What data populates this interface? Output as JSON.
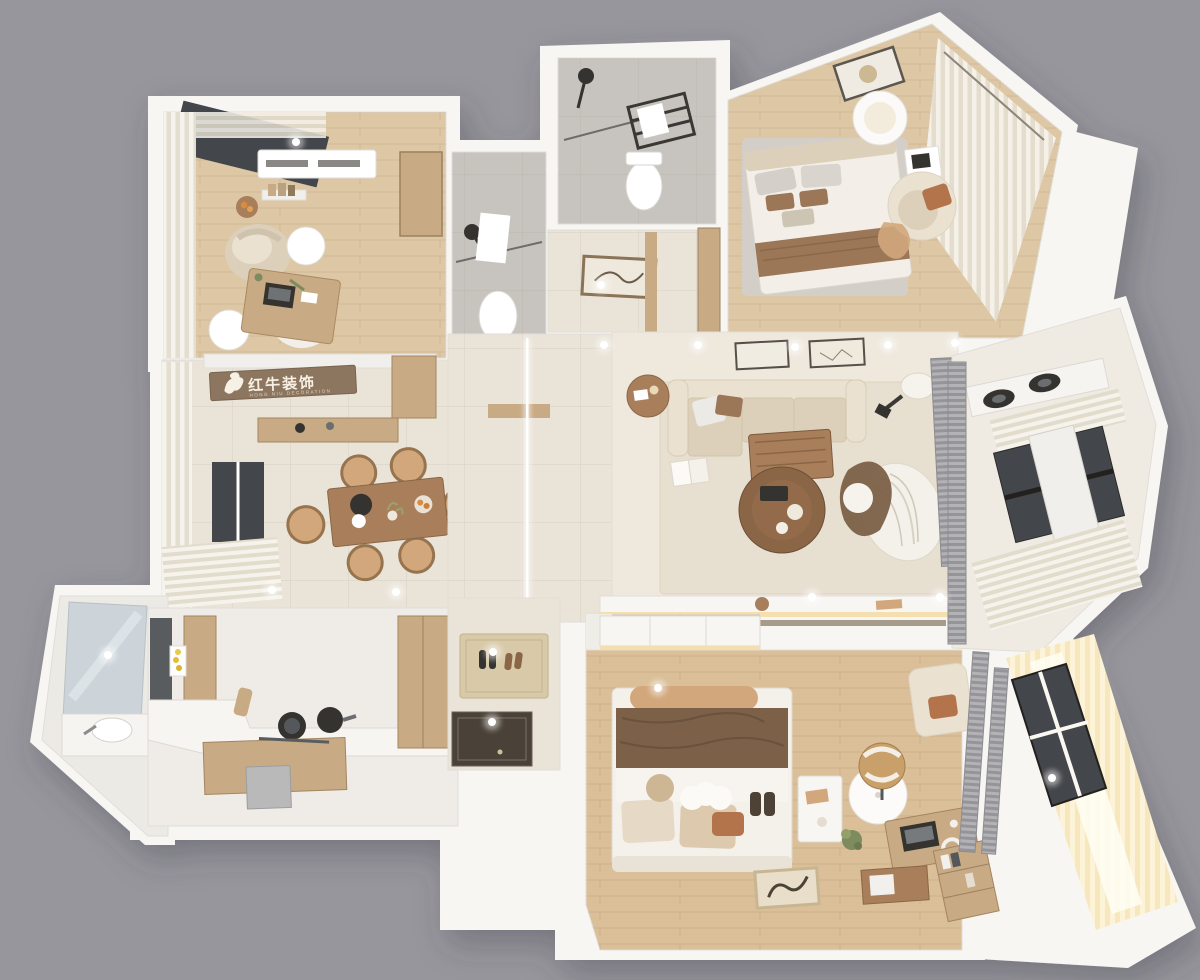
{
  "scene": {
    "type": "3d-apartment-floor-plan-render",
    "view": "top-down dollhouse",
    "canvas": {
      "width": 1200,
      "height": 980
    }
  },
  "logo": {
    "text": "红牛装饰",
    "subtext": "HONG NIU DECORATION"
  },
  "palette": {
    "bg": "#97969c",
    "slab": "#f7f6f3",
    "slabEdge": "#e1ded9",
    "offwhite": "#f1efeb",
    "white": "#ffffff",
    "floorTile": "#e9e3d8",
    "tileLine": "#d9d1c2",
    "wood": "#ddc7a5",
    "woodWarm": "#dabf98",
    "woodSoft": "#c8ab84",
    "woodMid": "#a97f5b",
    "woodDark": "#8a6647",
    "cream": "#ebe1d0",
    "creamDark": "#dcd0ba",
    "rug": "#e7dfd0",
    "rugGray": "#d3cfc8",
    "bathTile": "#c7c4bf",
    "glassDark": "#43464a",
    "mirror": "#ccd4d9",
    "linen": "#f2eee6",
    "glow": "#fbf0d4",
    "screen": "#a5a4a6",
    "brown": "#7c6048",
    "brownLight": "#9b7757",
    "terracotta": "#b3744b",
    "tan": "#d2a77c",
    "dark": "#35332f",
    "steel": "#595c5e",
    "ledWarm": "#f5dfae",
    "logoPanel": "#8d7660",
    "logoText": "#f6f0e5"
  },
  "rooms": [
    {
      "name": "study",
      "floor": "wood",
      "furniture": [
        "desk",
        "laptop",
        "armchair",
        "side-table",
        "shag-rug",
        "curtains",
        "ac-unit"
      ]
    },
    {
      "name": "bathroom-1",
      "floor": "gray-tile",
      "furniture": [
        "shower",
        "toilet",
        "towel"
      ]
    },
    {
      "name": "bathroom-2",
      "floor": "gray-tile",
      "furniture": [
        "shower",
        "toilet",
        "towel-ladder"
      ]
    },
    {
      "name": "bedroom-guest",
      "floor": "wood",
      "furniture": [
        "bed",
        "pendant-lamp",
        "armchair",
        "nightstand",
        "rug",
        "corner-curtains"
      ]
    },
    {
      "name": "dining-room",
      "floor": "beige-tile",
      "furniture": [
        "dining-table",
        "chairs-x6",
        "sideboard",
        "window-curtains"
      ]
    },
    {
      "name": "living-room",
      "floor": "beige-tile",
      "furniture": [
        "sofa",
        "coffee-table",
        "round-table",
        "lounge-chair",
        "floor-lamp",
        "tv-console",
        "rug"
      ]
    },
    {
      "name": "kitchen-balcony",
      "floor": "tile",
      "furniture": [
        "gas-hob",
        "window",
        "sheer-curtains",
        "louver-screen"
      ]
    },
    {
      "name": "laundry-bath",
      "floor": "tile",
      "furniture": [
        "mirror",
        "sink-counter"
      ]
    },
    {
      "name": "kitchen",
      "floor": "tile",
      "furniture": [
        "l-counter",
        "stove-pots",
        "fridge",
        "pantry",
        "island",
        "bin"
      ]
    },
    {
      "name": "entry",
      "floor": "beige-tile",
      "furniture": [
        "doormat",
        "shoes",
        "door-threshold"
      ]
    },
    {
      "name": "walk-in-closet",
      "floor": "wood",
      "furniture": [
        "cabinets",
        "glass-island"
      ]
    },
    {
      "name": "master-bedroom",
      "floor": "wood",
      "furniture": [
        "bed",
        "velvet-blanket",
        "pendant-lamp",
        "nightstand",
        "desk",
        "laptop",
        "desk-chair",
        "bench",
        "bookshelf",
        "floor-art",
        "storage-box"
      ]
    },
    {
      "name": "master-balcony",
      "floor": "wood",
      "furniture": [
        "glowing-curtains",
        "window",
        "louver-screens"
      ]
    }
  ]
}
